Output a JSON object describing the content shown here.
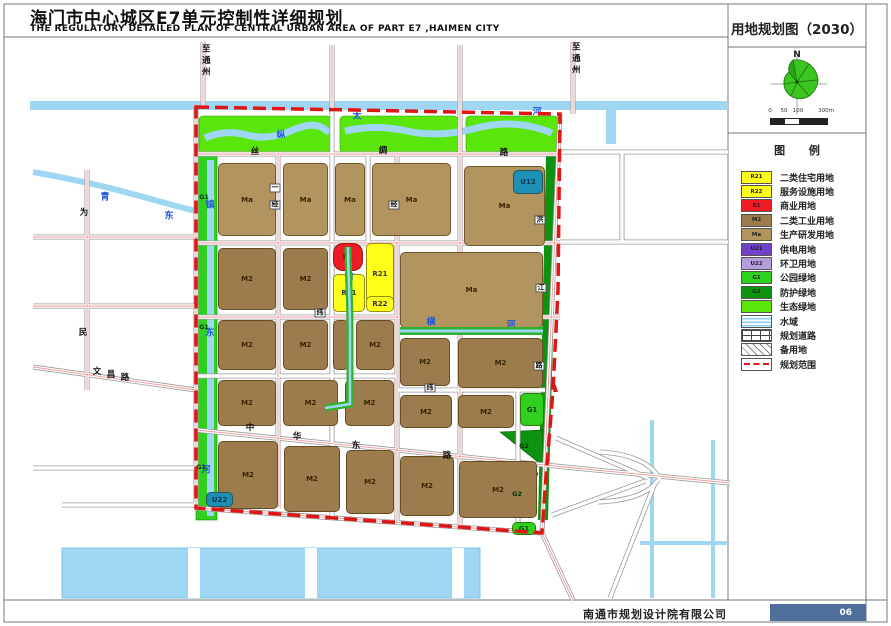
{
  "page": {
    "title_cn": "海门市中心城区E7单元控制性详细规划",
    "title_en": "THE REGULATORY DETAILED PLAN OF CENTRAL URBAN AREA OF PART E7 ,HAIMEN CITY",
    "map_title": "用地规划图（2030）",
    "company": "南通市规划设计院有限公司",
    "page_number": "06"
  },
  "colors": {
    "R21": "#ffff1a",
    "B1": "#ee1c25",
    "M2": "#9c7c4c",
    "Ma": "#b2945f",
    "U21": "#6f42c8",
    "U22": "#b39ddb",
    "TEAL": "#1e8fb5",
    "G1": "#30d01e",
    "G2": "#0e9210",
    "ECO": "#5ae60a",
    "WATER": "#9fd7f2",
    "BOUNDARY": "#e01515",
    "PAGEBOX": "#4f6f9a"
  },
  "panel": {
    "north_label": "N",
    "scale_ticks": [
      "0",
      "50",
      "100",
      "300m"
    ],
    "legend_title": "图  例",
    "legend": [
      {
        "code": "R21",
        "label": "二类住宅用地",
        "color": "#ffff1a",
        "style": "solid"
      },
      {
        "code": "R22",
        "label": "服务设施用地",
        "color": "#ffff1a",
        "style": "solid"
      },
      {
        "code": "B1",
        "label": "商业用地",
        "color": "#ee1c25",
        "style": "solid"
      },
      {
        "code": "M2",
        "label": "二类工业用地",
        "color": "#9c7c4c",
        "style": "solid"
      },
      {
        "code": "Ma",
        "label": "生产研发用地",
        "color": "#b2945f",
        "style": "solid"
      },
      {
        "code": "U21",
        "label": "供电用地",
        "color": "#6f42c8",
        "style": "solid"
      },
      {
        "code": "U22",
        "label": "环卫用地",
        "color": "#b39ddb",
        "style": "solid"
      },
      {
        "code": "G1",
        "label": "公园绿地",
        "color": "#30d01e",
        "style": "solid"
      },
      {
        "code": "G2",
        "label": "防护绿地",
        "color": "#0e9210",
        "style": "solid"
      },
      {
        "code": "",
        "label": "生态绿地",
        "color": "#5ae60a",
        "style": "solid"
      },
      {
        "code": "",
        "label": "水域",
        "color": "",
        "style": "water"
      },
      {
        "code": "",
        "label": "规划道路",
        "color": "",
        "style": "road"
      },
      {
        "code": "",
        "label": "备用地",
        "color": "",
        "style": "hatch"
      },
      {
        "code": "",
        "label": "规划范围",
        "color": "",
        "style": "dash"
      }
    ]
  },
  "map": {
    "parcels": [
      {
        "x": 218,
        "y": 163,
        "w": 58,
        "h": 73,
        "c": "Ma",
        "label": "Ma"
      },
      {
        "x": 283,
        "y": 163,
        "w": 45,
        "h": 73,
        "c": "Ma",
        "label": "Ma"
      },
      {
        "x": 335,
        "y": 163,
        "w": 30,
        "h": 73,
        "c": "Ma",
        "label": "Ma"
      },
      {
        "x": 372,
        "y": 163,
        "w": 79,
        "h": 73,
        "c": "Ma",
        "label": "Ma"
      },
      {
        "x": 464,
        "y": 166,
        "w": 81,
        "h": 80,
        "c": "Ma",
        "label": "Ma"
      },
      {
        "x": 513,
        "y": 170,
        "w": 30,
        "h": 24,
        "c": "TEAL",
        "label": "U12",
        "lc": "#0a3550"
      },
      {
        "x": 218,
        "y": 248,
        "w": 58,
        "h": 62,
        "c": "M2",
        "label": "M2"
      },
      {
        "x": 283,
        "y": 248,
        "w": 45,
        "h": 62,
        "c": "M2",
        "label": "M2"
      },
      {
        "x": 400,
        "y": 252,
        "w": 143,
        "h": 76,
        "c": "Ma",
        "label": "Ma"
      },
      {
        "x": 333,
        "y": 243,
        "w": 30,
        "h": 28,
        "c": "B1",
        "label": "B1",
        "lc": "#4d0303",
        "r": 10
      },
      {
        "x": 366,
        "y": 243,
        "w": 28,
        "h": 62,
        "c": "R21",
        "label": "R21",
        "lc": "#333"
      },
      {
        "x": 333,
        "y": 274,
        "w": 32,
        "h": 38,
        "c": "R21",
        "label": "R21",
        "lc": "#333"
      },
      {
        "x": 366,
        "y": 296,
        "w": 28,
        "h": 16,
        "c": "R21",
        "label": "R22",
        "lc": "#333"
      },
      {
        "x": 218,
        "y": 320,
        "w": 58,
        "h": 50,
        "c": "M2",
        "label": "M2"
      },
      {
        "x": 283,
        "y": 320,
        "w": 45,
        "h": 50,
        "c": "M2",
        "label": "M2"
      },
      {
        "x": 333,
        "y": 320,
        "w": 16,
        "h": 50,
        "c": "M2",
        "label": ""
      },
      {
        "x": 356,
        "y": 320,
        "w": 38,
        "h": 50,
        "c": "M2",
        "label": "M2"
      },
      {
        "x": 400,
        "y": 338,
        "w": 50,
        "h": 48,
        "c": "M2",
        "label": "M2"
      },
      {
        "x": 458,
        "y": 338,
        "w": 85,
        "h": 50,
        "c": "M2",
        "label": "M2"
      },
      {
        "x": 218,
        "y": 380,
        "w": 58,
        "h": 46,
        "c": "M2",
        "label": "M2"
      },
      {
        "x": 283,
        "y": 380,
        "w": 55,
        "h": 46,
        "c": "M2",
        "label": "M2"
      },
      {
        "x": 345,
        "y": 380,
        "w": 49,
        "h": 46,
        "c": "M2",
        "label": "M2"
      },
      {
        "x": 400,
        "y": 395,
        "w": 52,
        "h": 33,
        "c": "M2",
        "label": "M2"
      },
      {
        "x": 458,
        "y": 395,
        "w": 56,
        "h": 33,
        "c": "M2",
        "label": "M2"
      },
      {
        "x": 520,
        "y": 393,
        "w": 24,
        "h": 33,
        "c": "G1",
        "label": "G1",
        "lc": "#05400a"
      },
      {
        "x": 218,
        "y": 441,
        "w": 60,
        "h": 68,
        "c": "M2",
        "label": "M2"
      },
      {
        "x": 284,
        "y": 446,
        "w": 56,
        "h": 66,
        "c": "M2",
        "label": "M2"
      },
      {
        "x": 346,
        "y": 450,
        "w": 48,
        "h": 64,
        "c": "M2",
        "label": "M2"
      },
      {
        "x": 400,
        "y": 456,
        "w": 54,
        "h": 60,
        "c": "M2",
        "label": "M2"
      },
      {
        "x": 459,
        "y": 461,
        "w": 78,
        "h": 57,
        "c": "M2",
        "label": "M2"
      },
      {
        "x": 512,
        "y": 522,
        "w": 24,
        "h": 13,
        "c": "G1",
        "label": "G1",
        "lc": "#05400a"
      },
      {
        "x": 206,
        "y": 492,
        "w": 27,
        "h": 15,
        "c": "TEAL",
        "label": "U22",
        "lc": "#0a3550"
      }
    ],
    "labels": [
      {
        "t": "至通州",
        "x": 205,
        "y": 44,
        "cls": "vert"
      },
      {
        "t": "至通州",
        "x": 575,
        "y": 42,
        "cls": "vert"
      },
      {
        "t": "丝",
        "x": 255,
        "y": 152,
        "cls": ""
      },
      {
        "t": "绸",
        "x": 383,
        "y": 151,
        "cls": ""
      },
      {
        "t": "路",
        "x": 504,
        "y": 153,
        "cls": ""
      },
      {
        "t": "中",
        "x": 250,
        "y": 428,
        "cls": ""
      },
      {
        "t": "华",
        "x": 297,
        "y": 437,
        "cls": ""
      },
      {
        "t": "东",
        "x": 356,
        "y": 446,
        "cls": ""
      },
      {
        "t": "路",
        "x": 447,
        "y": 456,
        "cls": ""
      },
      {
        "t": "为",
        "x": 84,
        "y": 213,
        "cls": ""
      },
      {
        "t": "民",
        "x": 83,
        "y": 333,
        "cls": ""
      },
      {
        "t": "文",
        "x": 97,
        "y": 372,
        "cls": ""
      },
      {
        "t": "昌",
        "x": 111,
        "y": 375,
        "cls": ""
      },
      {
        "t": "路",
        "x": 125,
        "y": 378,
        "cls": ""
      },
      {
        "t": "洪",
        "x": 540,
        "y": 220,
        "cls": "plate"
      },
      {
        "t": "江",
        "x": 541,
        "y": 288,
        "cls": "plate"
      },
      {
        "t": "路",
        "x": 539,
        "y": 366,
        "cls": "plate"
      },
      {
        "t": "一",
        "x": 275,
        "y": 188,
        "cls": "plate"
      },
      {
        "t": "经",
        "x": 275,
        "y": 205,
        "cls": "plate"
      },
      {
        "t": "经",
        "x": 394,
        "y": 205,
        "cls": "plate"
      },
      {
        "t": "纬",
        "x": 320,
        "y": 313,
        "cls": "plate"
      },
      {
        "t": "纬",
        "x": 430,
        "y": 388,
        "cls": "plate"
      },
      {
        "t": "纵",
        "x": 281,
        "y": 136,
        "cls": "blue"
      },
      {
        "t": "太",
        "x": 357,
        "y": 117,
        "cls": "blue"
      },
      {
        "t": "河",
        "x": 537,
        "y": 113,
        "cls": "blue"
      },
      {
        "t": "青",
        "x": 105,
        "y": 198,
        "cls": "blue"
      },
      {
        "t": "东",
        "x": 169,
        "y": 217,
        "cls": "blue"
      },
      {
        "t": "镇",
        "x": 210,
        "y": 206,
        "cls": "blue"
      },
      {
        "t": "东",
        "x": 210,
        "y": 334,
        "cls": "blue"
      },
      {
        "t": "河",
        "x": 206,
        "y": 471,
        "cls": "blue"
      },
      {
        "t": "河",
        "x": 349,
        "y": 279,
        "cls": "blue"
      },
      {
        "t": "横",
        "x": 431,
        "y": 323,
        "cls": "blue"
      },
      {
        "t": "河",
        "x": 511,
        "y": 326,
        "cls": "blue"
      },
      {
        "t": "G1",
        "x": 204,
        "y": 197,
        "cls": "gcode"
      },
      {
        "t": "G1",
        "x": 204,
        "y": 327,
        "cls": "gcode"
      },
      {
        "t": "G1",
        "x": 201,
        "y": 467,
        "cls": "gcode"
      },
      {
        "t": "G2",
        "x": 524,
        "y": 446,
        "cls": "gcode"
      },
      {
        "t": "G2",
        "x": 517,
        "y": 494,
        "cls": "gcode"
      }
    ]
  }
}
